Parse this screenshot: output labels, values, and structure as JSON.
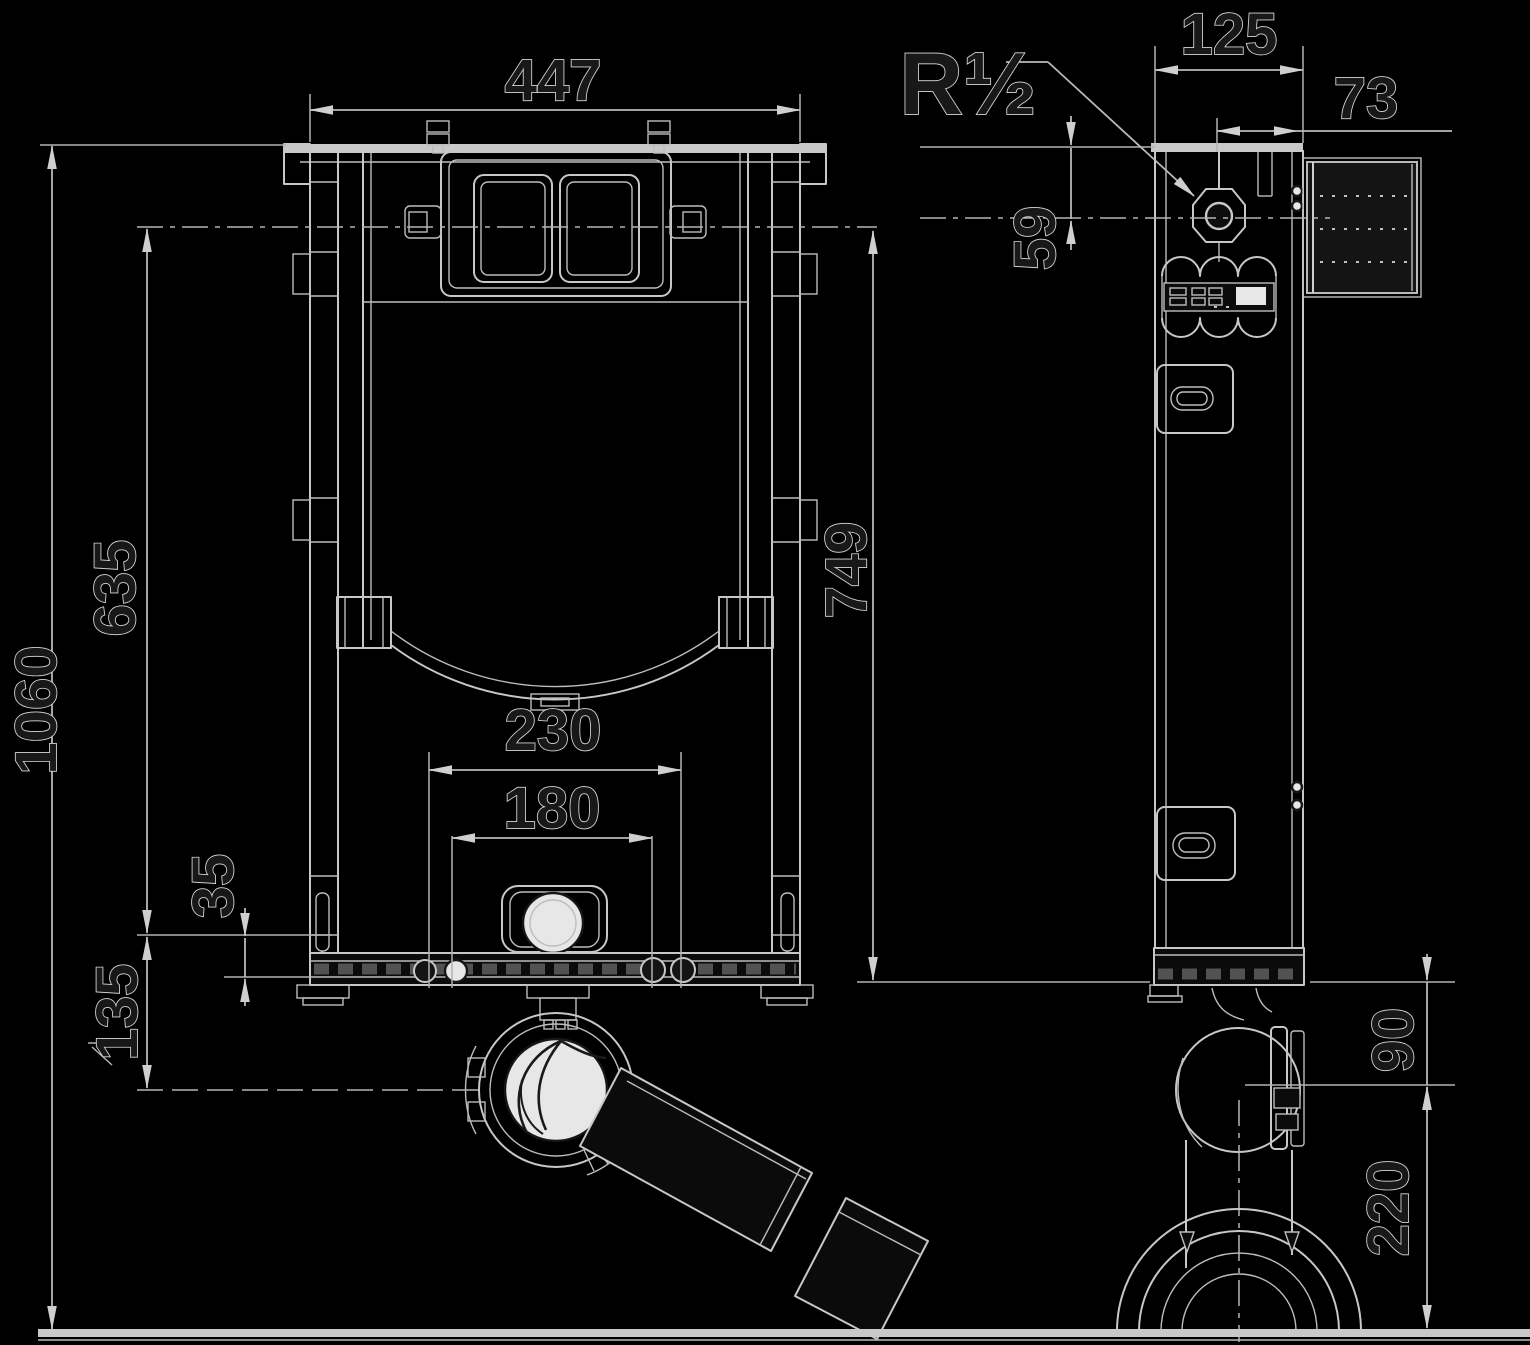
{
  "drawing": {
    "subject": "in-wall-cistern-frame-technical-drawing",
    "unit": "mm",
    "views": [
      "front-elevation",
      "side-elevation"
    ],
    "parts": [
      "mounting-frame",
      "cistern",
      "dual-flush-actuator-plate",
      "flush-buttons",
      "water-supply-connection",
      "corrugated-flush-pipe",
      "service-opening",
      "bowl-support-bracket",
      "drain-elbow",
      "outlet-pipe",
      "outlet-spigot",
      "adjustable-feet",
      "floor-line",
      "wall-anchor-brackets"
    ]
  },
  "colors": {
    "background": "#000000",
    "line": "#c7c7c7",
    "text_fill": "#181818",
    "text_outline": "#d6d6d6",
    "fill_light": "#e7e7e7",
    "fill_dark": "#0b0b0b"
  },
  "dims": {
    "w447": {
      "label": "447",
      "value": 447,
      "unit": "mm",
      "axis": "horizontal",
      "view": "front",
      "measures": "overall frame width"
    },
    "h1060": {
      "label": "1060",
      "value": 1060,
      "unit": "mm",
      "axis": "vertical",
      "view": "front",
      "measures": "overall frame height above floor"
    },
    "h635": {
      "label": "635",
      "value": 635,
      "unit": "mm",
      "axis": "vertical",
      "view": "front",
      "measures": "actuator level to foot reference"
    },
    "h749": {
      "label": "749",
      "value": 749,
      "unit": "mm",
      "axis": "vertical",
      "view": "front",
      "measures": "frame height to base"
    },
    "w230": {
      "label": "230",
      "value": 230,
      "unit": "mm",
      "axis": "horizontal",
      "view": "front",
      "measures": "outer fixing bolt spacing"
    },
    "w180": {
      "label": "180",
      "value": 180,
      "unit": "mm",
      "axis": "horizontal",
      "view": "front",
      "measures": "inner fixing bolt spacing"
    },
    "h35": {
      "label": "35",
      "value": 35,
      "unit": "mm",
      "axis": "vertical",
      "view": "front",
      "measures": "outlet reference to frame base"
    },
    "h135": {
      "label": "135",
      "value": 135,
      "unit": "mm",
      "axis": "vertical",
      "view": "front",
      "measures": "outlet reference to drain axis"
    },
    "w125": {
      "label": "125",
      "value": 125,
      "unit": "mm",
      "axis": "horizontal",
      "view": "side",
      "measures": "frame depth"
    },
    "w73": {
      "label": "73",
      "value": 73,
      "unit": "mm",
      "axis": "horizontal",
      "view": "side",
      "measures": "flush bend to wall face"
    },
    "h59": {
      "label": "59",
      "value": 59,
      "unit": "mm",
      "axis": "vertical",
      "view": "side",
      "measures": "frame top to supply axis"
    },
    "h90": {
      "label": "90",
      "value": 90,
      "unit": "mm",
      "axis": "vertical",
      "view": "side",
      "measures": "frame base to outlet axis"
    },
    "h220": {
      "label": "220",
      "value": 220,
      "unit": "mm",
      "axis": "vertical",
      "view": "side",
      "measures": "outlet axis to floor"
    }
  },
  "annotations": {
    "r_half": {
      "label": "R½",
      "meaning": "water supply thread size",
      "points_to": "water-supply-connection"
    }
  }
}
